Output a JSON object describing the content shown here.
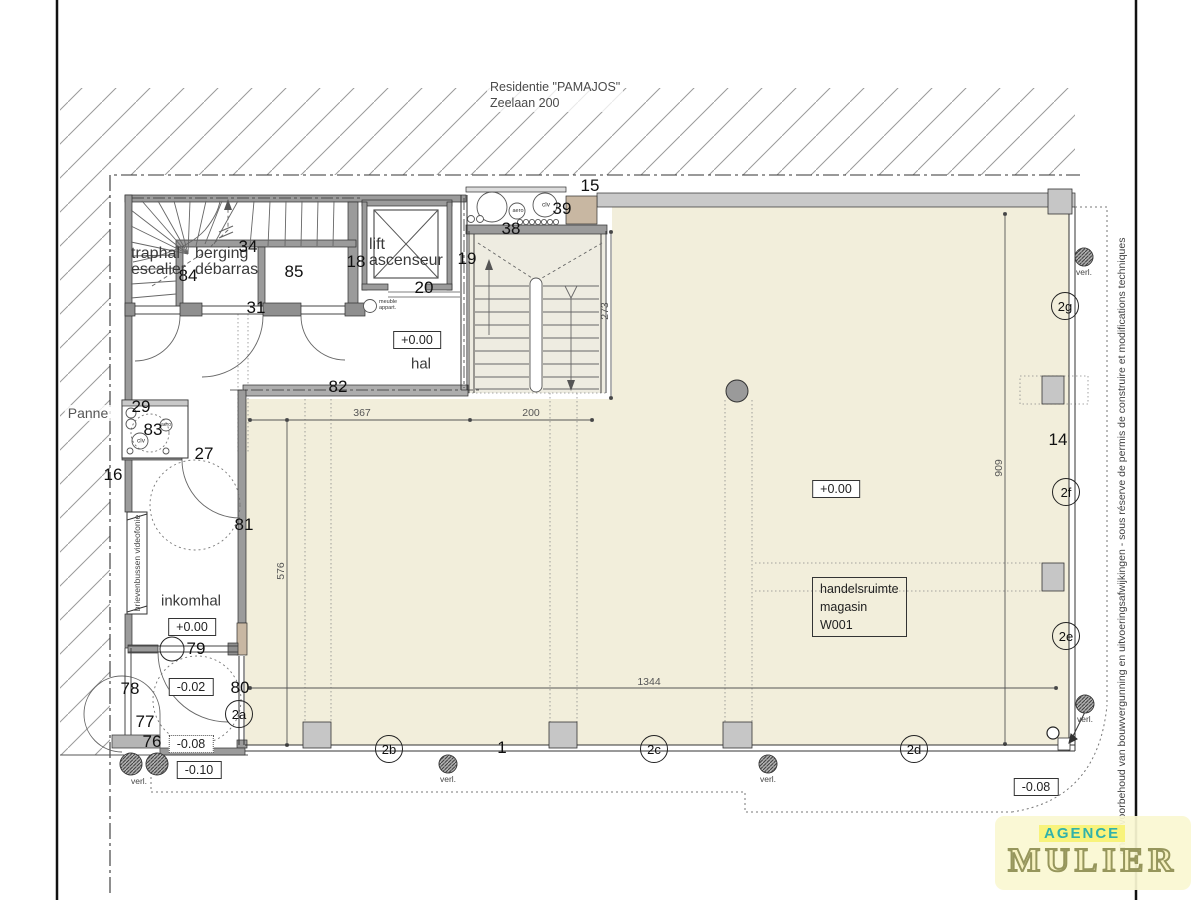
{
  "title": {
    "line1": "Residentie \"PAMAJOS\"",
    "line2": "Zeelaan 200"
  },
  "site": {
    "area_label": "Panne",
    "note": "onder voorbehoud van bouwvergunning en uitvoeringsafwijkingen - sous réserve de permis de construire et modifications techniques"
  },
  "rooms": {
    "traphal_line1": "traphal",
    "traphal_line2": "escalier",
    "berging_line1": "berging",
    "berging_line2": "débarras",
    "lift_line1": "lift",
    "lift_line2": "ascenseur",
    "hal": "hal",
    "inkomhal": "inkomhal",
    "shop_line1": "handelsruimte",
    "shop_line2": "magasin",
    "shop_line3": "W001",
    "mailbox": "brievenbussen videofonie"
  },
  "levels": {
    "hal": "+0.00",
    "inkomhal": "+0.00",
    "shop": "+0.00",
    "vestibule": "-0.02",
    "entrance": "-0.08",
    "sidewalk": "-0.10",
    "corner": "-0.08"
  },
  "dimensions": {
    "d367": "367",
    "d200": "200",
    "d576": "576",
    "d909": "909",
    "d273": "273",
    "d1344": "1344"
  },
  "part_numbers": {
    "n1": "1",
    "n14": "14",
    "n15": "15",
    "n16": "16",
    "n18": "18",
    "n19": "19",
    "n20": "20",
    "n27": "27",
    "n29": "29",
    "n31": "31",
    "n34": "34",
    "n38": "38",
    "n39": "39",
    "n76": "76",
    "n77": "77",
    "n78": "78",
    "n79": "79",
    "n80": "80",
    "n81": "81",
    "n82": "82",
    "n83": "83",
    "n84": "84",
    "n85": "85"
  },
  "bubbles": {
    "b2a": "2a",
    "b2b": "2b",
    "b2c": "2c",
    "b2d": "2d",
    "b2e": "2e",
    "b2f": "2f",
    "b2g": "2g"
  },
  "annotations": {
    "clv": "clv",
    "aero": "aero",
    "meuble_line1": "meuble",
    "meuble_line2": "appart.",
    "verl": "verl."
  },
  "logo": {
    "agence": "AGENCE",
    "mulier": "MULIER"
  },
  "colors": {
    "beige": "#f2eedb",
    "stair_fill": "#eeece1",
    "wall_gray": "#9b9b9b",
    "column_gray": "#c6c6c6",
    "tan_shaft": "#c8b7a2",
    "logo_teal": "#31b2aa",
    "logo_cream": "#f7f2c0",
    "logo_yellow": "#f8f37b"
  }
}
